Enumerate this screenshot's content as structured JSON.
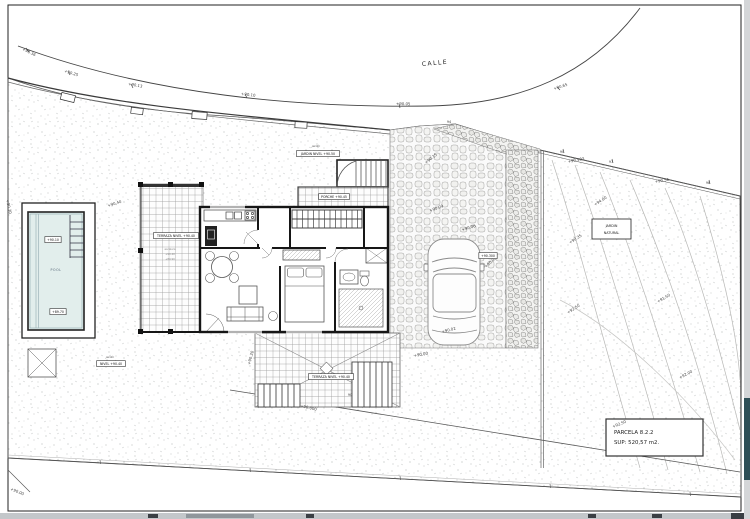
{
  "doc": {
    "street_label": "CALLE",
    "pool_label": "POOL",
    "legend": {
      "line1": "PARCELA 8.2.2",
      "line2": "SUP: 520,57 m2."
    },
    "natural_garden": {
      "line1": "JARDIN",
      "line2": "NATURAL"
    }
  },
  "colors": {
    "pool_water": "#e2eeec",
    "paper": "#ffffff",
    "frame_line": "#222222",
    "scroll_thumb": "#2e4f57",
    "ui_strip": "#c3c7ca"
  },
  "labels": [
    {
      "kind": "elev",
      "t": "+90.36",
      "x": 22,
      "y": 50,
      "r": 26
    },
    {
      "kind": "elev",
      "t": "+90.25",
      "x": 64,
      "y": 72,
      "r": 18
    },
    {
      "kind": "elev",
      "t": "+90.13",
      "x": 128,
      "y": 85,
      "r": 11
    },
    {
      "kind": "elev",
      "t": "+90.10",
      "x": 241,
      "y": 95,
      "r": 7
    },
    {
      "kind": "elev",
      "t": "+90.05",
      "x": 396,
      "y": 105,
      "r": 1
    },
    {
      "kind": "elev",
      "t": "+90.65",
      "x": 554,
      "y": 90,
      "r": -18
    },
    {
      "kind": "elev",
      "t": "+90.503",
      "x": 568,
      "y": 163,
      "r": -11
    },
    {
      "kind": "elev",
      "t": "+90.56",
      "x": 655,
      "y": 183,
      "r": -9
    },
    {
      "kind": "elev",
      "t": "+90.15",
      "x": 426,
      "y": 164,
      "r": -38
    },
    {
      "kind": "elev",
      "t": "+90.09",
      "x": 430,
      "y": 212,
      "r": -20
    },
    {
      "kind": "elev",
      "t": "+90.06",
      "x": 462,
      "y": 231,
      "r": -16
    },
    {
      "kind": "elev",
      "t": "+90.08",
      "x": 486,
      "y": 268,
      "r": -42
    },
    {
      "kind": "elev",
      "t": "+90.02",
      "x": 442,
      "y": 333,
      "r": -14
    },
    {
      "kind": "elev",
      "t": "+90.00",
      "x": 414,
      "y": 357,
      "r": -10
    },
    {
      "kind": "elev",
      "t": "+94.00",
      "x": 595,
      "y": 206,
      "r": -33
    },
    {
      "kind": "elev",
      "t": "+90.35",
      "x": 570,
      "y": 244,
      "r": -33
    },
    {
      "kind": "elev",
      "t": "+92.50",
      "x": 568,
      "y": 314,
      "r": -33
    },
    {
      "kind": "elev",
      "t": "+91.50",
      "x": 658,
      "y": 303,
      "r": -30
    },
    {
      "kind": "elev",
      "t": "+92.00",
      "x": 680,
      "y": 379,
      "r": -28
    },
    {
      "kind": "elev",
      "t": "+92.50",
      "x": 613,
      "y": 428,
      "r": -22
    },
    {
      "kind": "elev",
      "t": "+90.000",
      "x": 300,
      "y": 407,
      "r": 13
    },
    {
      "kind": "elev",
      "t": "+90.00",
      "x": 10,
      "y": 490,
      "r": 22
    },
    {
      "kind": "elev",
      "t": "+90.30",
      "x": 6,
      "y": 200,
      "r": 77
    },
    {
      "kind": "elev",
      "t": "+90.40",
      "x": 108,
      "y": 207,
      "r": -18
    },
    {
      "kind": "elev",
      "t": "+90.20",
      "x": 250,
      "y": 365,
      "r": -75
    },
    {
      "kind": "num",
      "t": "94",
      "x": 449,
      "y": 123
    },
    {
      "kind": "num",
      "t": "90",
      "x": 562,
      "y": 153
    },
    {
      "kind": "num",
      "t": "97",
      "x": 611,
      "y": 163
    },
    {
      "kind": "num",
      "t": "98",
      "x": 708,
      "y": 184
    },
    {
      "kind": "num",
      "t": "90",
      "x": 350,
      "y": 396
    },
    {
      "kind": "box",
      "t": "TERRAZA NIVEL +90.40",
      "x": 176,
      "y": 236
    },
    {
      "kind": "box",
      "t": "PORCHE +90.45",
      "x": 334,
      "y": 197
    },
    {
      "kind": "box",
      "t": "JARDIN NIVEL +90.50",
      "x": 318,
      "y": 154
    },
    {
      "kind": "box",
      "t": "TERRAZA NIVEL +90.40",
      "x": 331,
      "y": 377
    },
    {
      "kind": "box",
      "t": "+90.300",
      "x": 488,
      "y": 256
    },
    {
      "kind": "box",
      "t": "NIVEL +90.40",
      "x": 111,
      "y": 364
    },
    {
      "kind": "box",
      "t": "+90.10",
      "x": 53,
      "y": 240
    },
    {
      "kind": "box",
      "t": "+89.70",
      "x": 58,
      "y": 312
    },
    {
      "kind": "cap",
      "t": "jardín",
      "x": 316,
      "y": 147
    },
    {
      "kind": "cap",
      "t": "jardín",
      "x": 110,
      "y": 358
    },
    {
      "kind": "tiny",
      "t": "escalera",
      "x": 170,
      "y": 250
    },
    {
      "kind": "tiny",
      "t": "+90.40",
      "x": 170,
      "y": 255
    },
    {
      "kind": "tiny",
      "t": "+89.90",
      "x": 170,
      "y": 260
    }
  ]
}
